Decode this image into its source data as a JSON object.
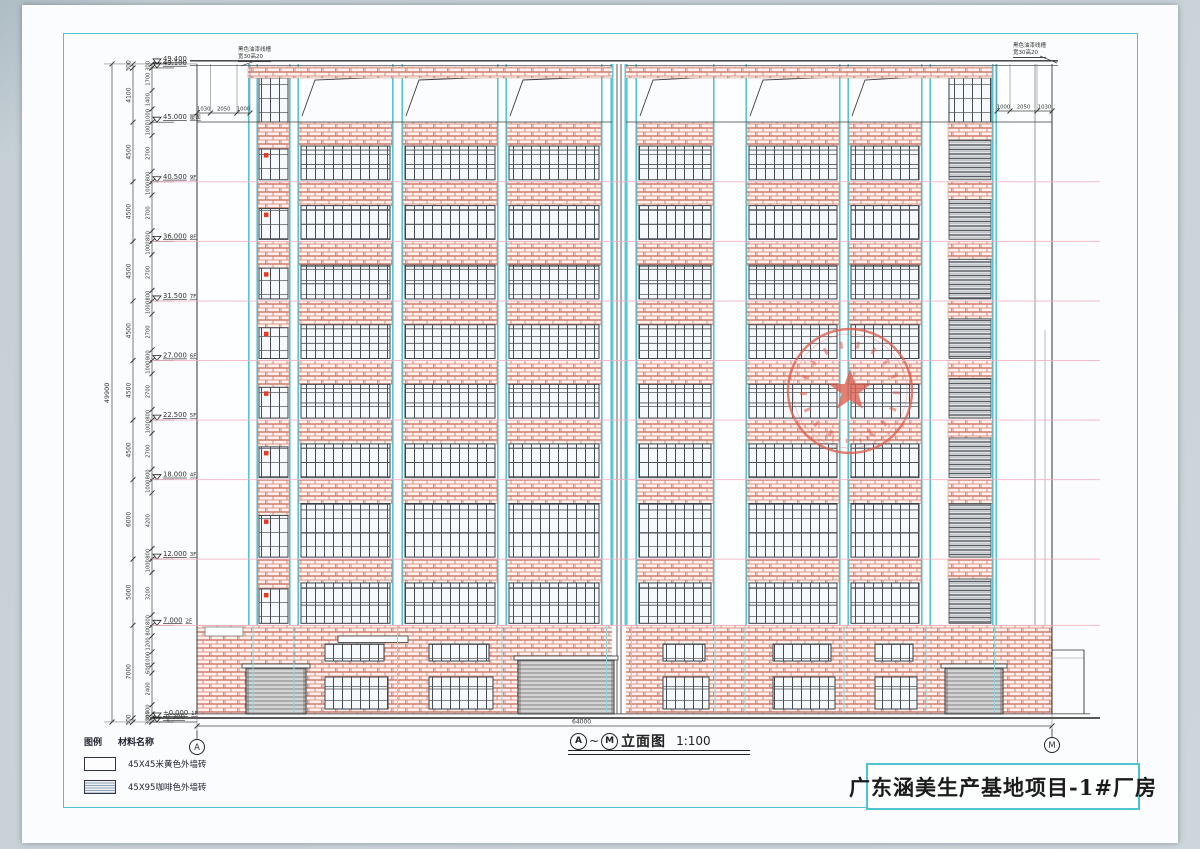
{
  "title_block": {
    "text": "广东涵美生产基地项目-1#厂房"
  },
  "caption": {
    "grid_start": "A",
    "grid_end": "M",
    "drawing_name": "立面图",
    "scale": "1:100"
  },
  "bottom_dim": "64000",
  "grid_bubbles": {
    "left": "A",
    "right": "M"
  },
  "legend": {
    "col_symbol": "图例",
    "col_name": "材料名称",
    "items": [
      {
        "name": "45X45米黄色外墙砖",
        "swatch": "plain"
      },
      {
        "name": "45X95咖啡色外墙砖",
        "swatch": "hatch"
      }
    ]
  },
  "annotations": {
    "left": [
      "黑色油漆线槽",
      "宽30高20"
    ],
    "right": [
      "黑色油漆线槽",
      "宽30高20"
    ]
  },
  "top_dims": {
    "left": [
      "1030",
      "2050",
      "1000"
    ],
    "right": [
      "1000",
      "2050",
      "1030"
    ]
  },
  "levels": [
    {
      "value": "49.400",
      "tag": "",
      "m": 49.4
    },
    {
      "value": "49.100",
      "tag": "",
      "m": 49.1
    },
    {
      "value": "45.000",
      "tag": "屋面",
      "m": 45.0
    },
    {
      "value": "40.500",
      "tag": "9F",
      "m": 40.5
    },
    {
      "value": "36.000",
      "tag": "8F",
      "m": 36.0
    },
    {
      "value": "31.500",
      "tag": "7F",
      "m": 31.5
    },
    {
      "value": "27.000",
      "tag": "6F",
      "m": 27.0
    },
    {
      "value": "22.500",
      "tag": "5F",
      "m": 22.5
    },
    {
      "value": "18.000",
      "tag": "4F",
      "m": 18.0
    },
    {
      "value": "12.000",
      "tag": "3F",
      "m": 12.0
    },
    {
      "value": "7.000",
      "tag": "2F",
      "m": 7.0
    },
    {
      "value": "±0.000",
      "tag": "1F",
      "m": 0.0
    },
    {
      "value": "-0.300",
      "tag": "",
      "m": -0.3
    }
  ],
  "dim_total": "49900",
  "dims_outer_mm": [
    300,
    4100,
    4500,
    4500,
    4500,
    4500,
    4500,
    4500,
    6000,
    5000,
    7000,
    300
  ],
  "dims_inner_mm": [
    300,
    1700,
    1400,
    1000,
    1000,
    2700,
    800,
    1000,
    2700,
    800,
    1000,
    2700,
    800,
    1000,
    2700,
    800,
    1000,
    2700,
    800,
    1000,
    2700,
    800,
    1000,
    4200,
    800,
    1000,
    3200,
    800,
    800,
    1200,
    1000,
    600,
    2400,
    700,
    300,
    300
  ],
  "colors": {
    "brick_line": "#d07a6c",
    "cyan_pilaster": "#49c2d0",
    "level_line_pink": "#f3b0c0",
    "stamp_red": "#dd5f4f",
    "window_tag_red": "#e03c28"
  },
  "stamp": {
    "shape": "circle-with-star"
  }
}
